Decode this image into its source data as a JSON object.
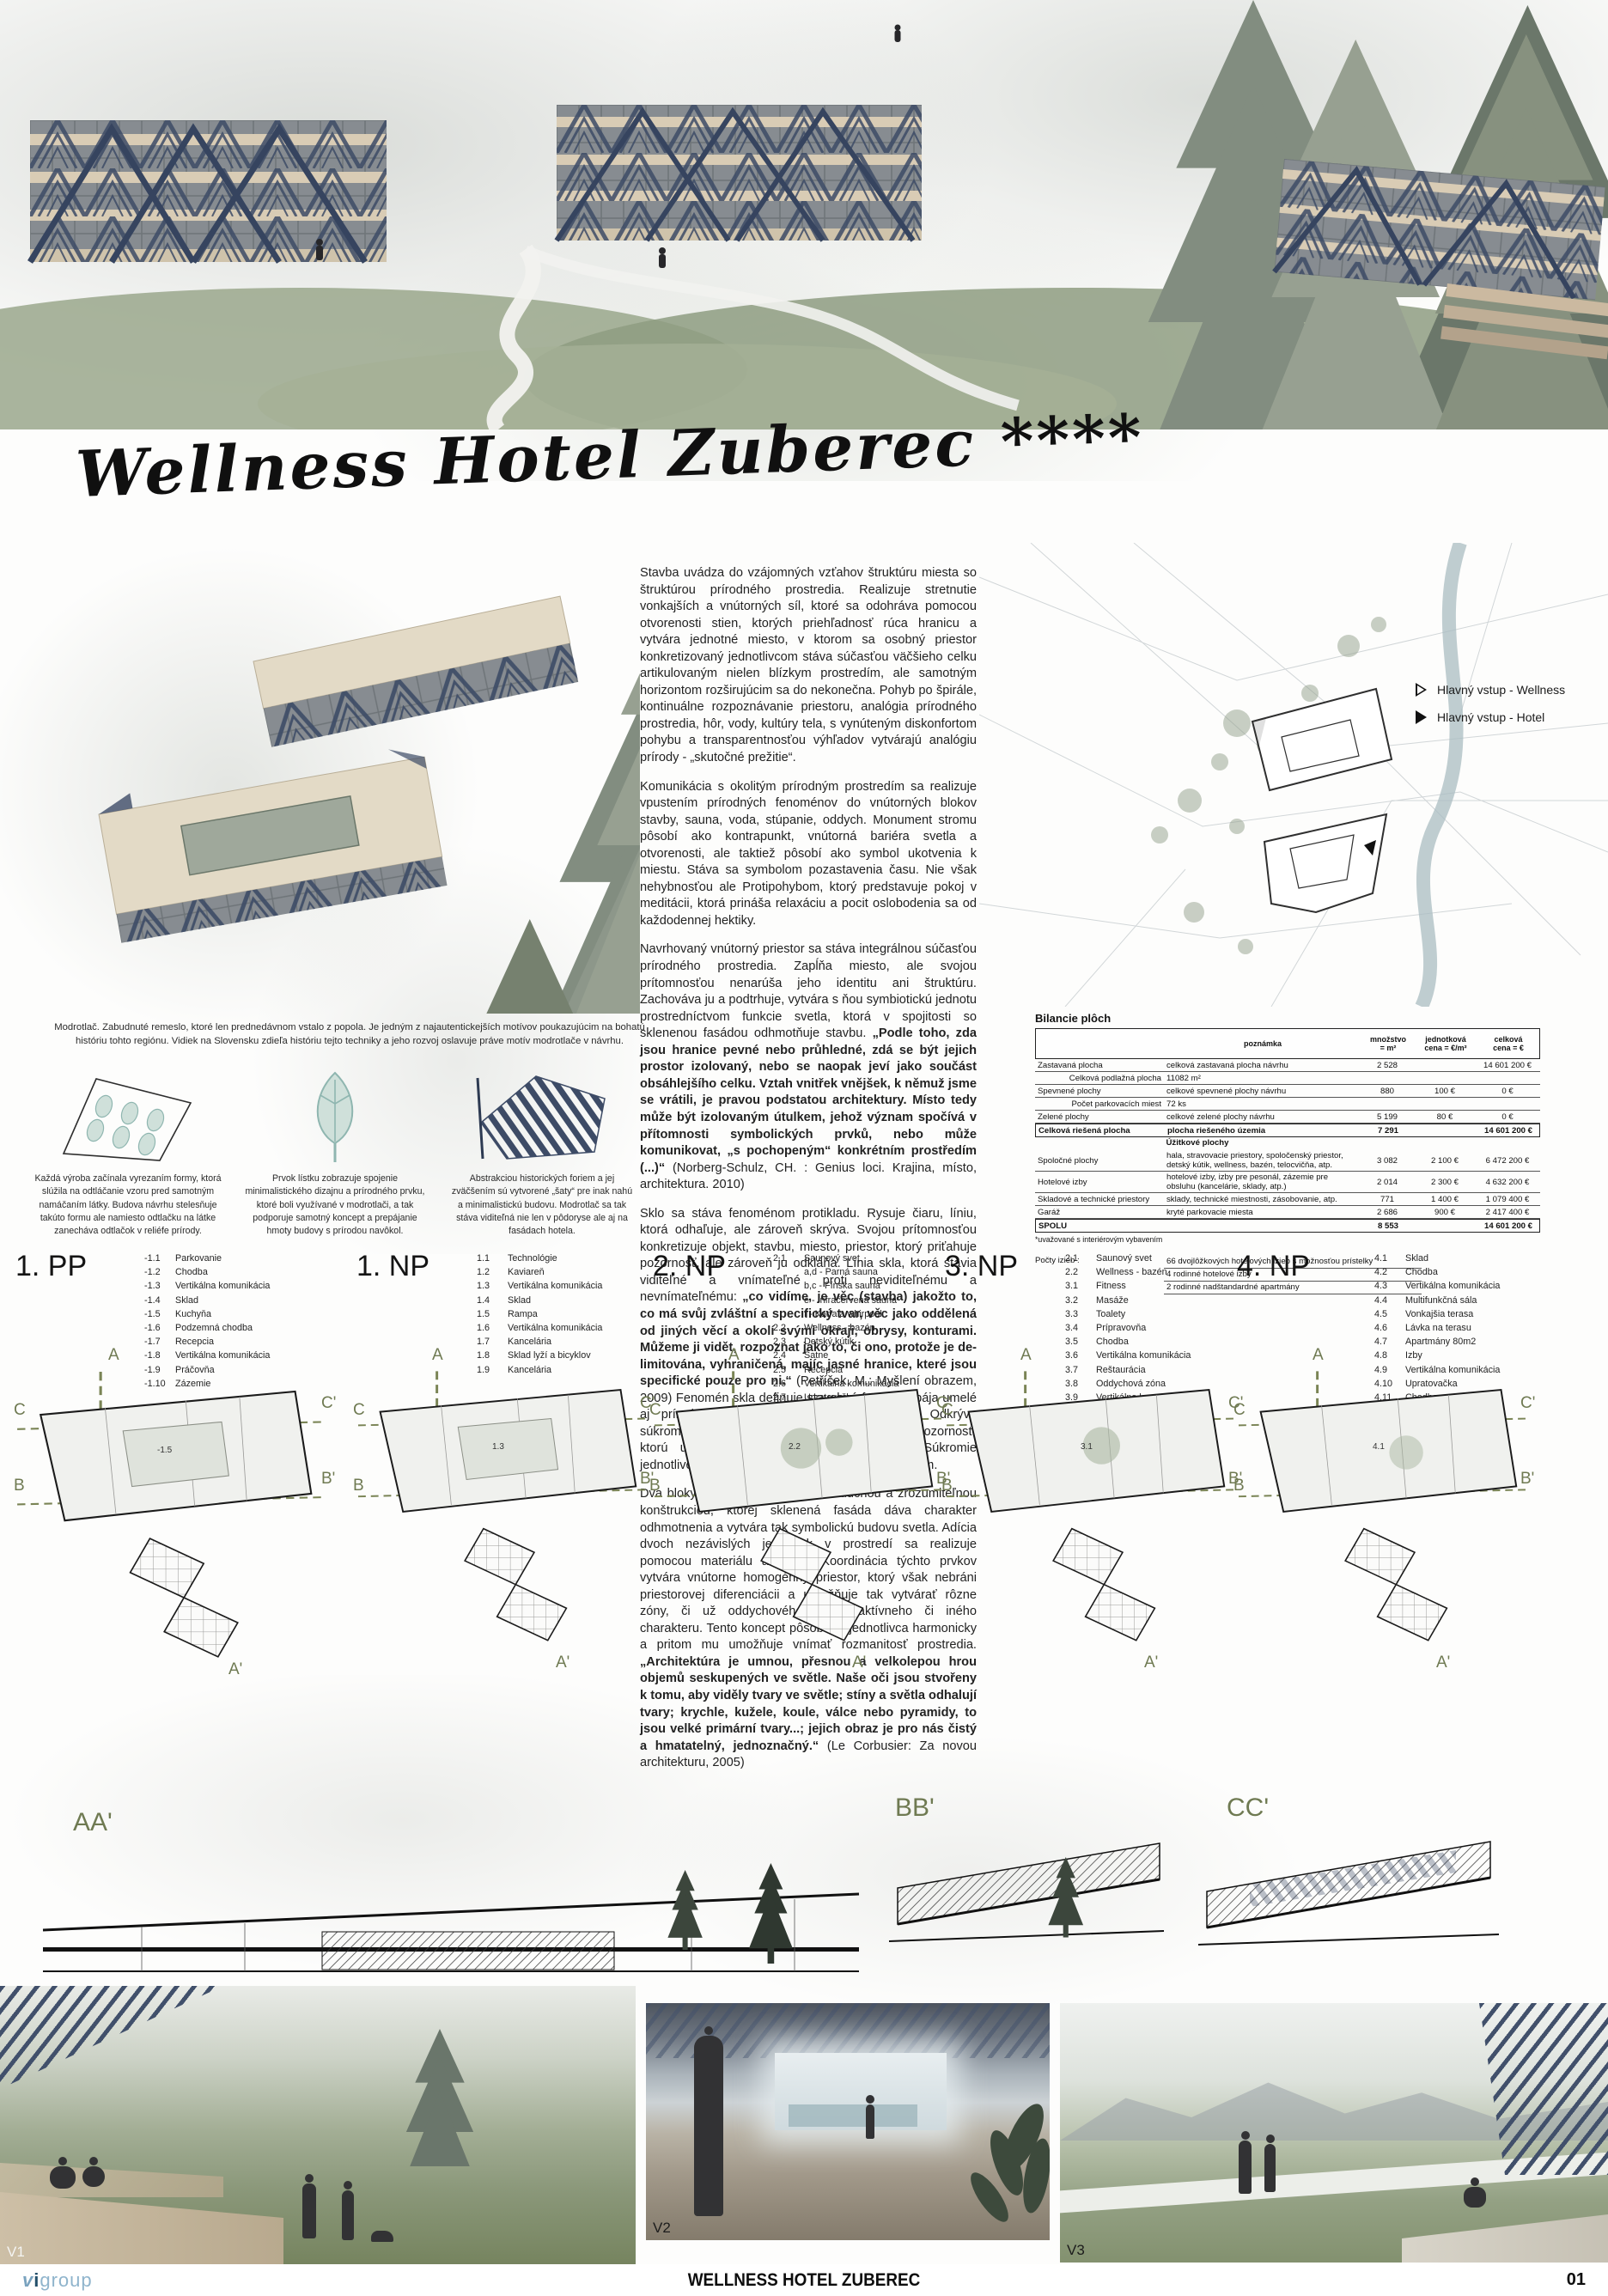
{
  "board": {
    "title_script": "Wellness Hotel Zuberec ****",
    "footer_title": "WELLNESS HOTEL ZUBEREC",
    "page_number": "01",
    "logo": {
      "mark_v": "v",
      "mark_i": "i",
      "word": "group"
    }
  },
  "colors": {
    "accent_navy": "#3d4b66",
    "olive": "#6f7a52",
    "sage_green": "#97a388",
    "beige_band": "#d9ccb5",
    "teal_leaf": "#9dbbb6",
    "logo_blue": "#24506b",
    "logo_light_blue": "#8fb4cc"
  },
  "site_legend": {
    "wellness": "Hlavný vstup - Wellness",
    "hotel": "Hlavný vstup - Hotel"
  },
  "essay": {
    "paragraphs": [
      [
        {
          "t": "Stavba uvádza do vzájomných vzťahov štruktúru miesta so štruktúrou prírodného prostredia. Realizuje stretnutie vonkajších a vnútorných síl, ktoré sa odohráva pomocou otvorenosti stien, ktorých priehľadnosť rúca hranicu a vytvára jednotné miesto, v ktorom sa osobný priestor konkretizovaný jednotlivcom stáva súčasťou väčšieho celku artikulovaným nielen blízkym prostredím, ale samotným horizontom rozširujúcim sa do nekonečna. Pohyb po špirále, kontinuálne rozpoznávanie priestoru, analógia prírodného prostredia, hôr, vody, kultúry tela, s vynúteným diskonfortom pohybu a transparentnosťou výhľadov vytvárajú analógiu prírody - „skutočné prežitie“."
        }
      ],
      [
        {
          "t": "Komunikácia s okolitým prírodným prostredím sa realizuje vpustením prírodných fenoménov do vnútorných blokov stavby, sauna, voda, stúpanie, oddych.  Monument stromu pôsobí ako kontrapunkt, vnútorná bariéra svetla a otvorenosti, ale taktiež pôsobí ako symbol ukotvenia k miestu. Stáva sa symbolom pozastavenia času. Nie však nehybnosťou ale Protipohybom, ktorý predstavuje pokoj v meditácii, ktorá prináša relaxáciu a pocit oslobodenia sa od každodennej hektiky."
        }
      ],
      [
        {
          "t": "Navrhovaný vnútorný priestor sa stáva integrálnou súčasťou prírodného prostredia. Zapĺňa miesto, ale svojou prítomnosťou nenarúša jeho identitu ani štruktúru. Zachováva ju a podtrhuje, vytvára s ňou symbiotickú jednotu prostredníctvom funkcie svetla, ktorá v spojitosti so sklenenou fasádou odhmotňuje stavbu. "
        },
        {
          "t": "„Podle toho, zda jsou hranice pevné nebo průhledné, zdá se být jejich prostor izolovaný, nebo se naopak jeví jako součást obsáhlejšího celku. Vztah vnitřek vnějšek, k němuž jsme se vrátili, je pravou podstatou architektury. Místo tedy může být izolovaným útulkem, jehož význam spočívá v přítomnosti symbolických prvků, nebo může komunikovat, „s pochopeným“ konkrétním prostředím (...)“",
          "b": true
        },
        {
          "t": " (Norberg-Schulz, CH. : Genius loci. Krajina, místo, architektura. 2010)"
        }
      ],
      [
        {
          "t": "Sklo sa stáva fenoménom protikladu. Rysuje čiaru, líniu, ktorá odhaľuje, ale zároveň skrýva. Svojou prítomnosťou konkretizuje objekt, stavbu, miesto, priestor, ktorý priťahuje pozornosť, ale zároveň ju odkláňa. Línia skla, ktorá stavia viditeľné a vnímateľné proti neviditeľnému a nevnímateľnému: "
        },
        {
          "t": "„co vidíme, je věc (stavba) jakožto to, co má svůj zvláštní a specifický tvar, věc jako oddělená od jiných věcí a okolí svými okraji, obrysy, konturami. Můžeme ji vidět, rozpoznat jako to, či ono, protože je de-limitována, vyhraničená, majíc jasné hranice, které jsou specifické pouze pro ni.“",
          "b": true
        },
        {
          "t": " (Petříček, M.: Myšlení obrazem, 2009) Fenomén skla definuje stavebnú formu a spája umelé aj prírodné prostredie do jednotného celku. Odkrýva súkromný priestor, ale zároveň od neho odkláňa pozornosť, ktorú upútavajú možnosti okolitej scenérie. Súkromie jednotlivca sa tak stáva anonymným a nepodstatným."
        }
      ],
      [
        {
          "t": "Dva bloky jednotnej stavby s jednoduchou a zrozumiteľnou konštrukciou, ktorej sklenená fasáda dáva charakter odhmotnenia a vytvára tak symbolickú budovu svetla. Adícia dvoch nezávislých jednotiek v prostredí sa realizuje pomocou materiálu a formy. Koordinácia týchto prvkov vytvára vnútorne homogénny priestor, ktorý však nebráni priestorovej diferenciácii a umožňuje tak vytvárať rôzne zóny, či už oddychového alebo aktívneho či iného charakteru. Tento koncept pôsobí na jednotlivca harmonicky a pritom mu umožňuje vnímať rozmanitosť prostredia. "
        },
        {
          "t": "„Architektúra je umnou, přesnou a velkolepou hrou objemů seskupených ve světle. Naše oči jsou stvořeny k tomu, aby viděly tvary ve světle; stíny a světla odhalují tvary; krychle, kužele, koule, válce nebo pyramidy, to jsou velké primární tvary...; jejich obraz je pro nás čistý a hmatatelný, jednoznačný.“",
          "b": true
        },
        {
          "t": " (Le Corbusier: Za novou architekturu, 2005)"
        }
      ]
    ]
  },
  "axon_caption": "Modrotlač. Zabudnuté remeslo, ktoré len prednedávnom vstalo z popola. Je jedným z najautentickejších motívov poukazujúcim na bohatú históriu tohto regiónu. Vidiek na Slovensku zdieľa históriu tejto techniky a jeho rozvoj oslavuje práve motív modrotlače v návrhu.",
  "concepts": [
    {
      "caption": "Každá výroba začínala vyrezaním formy, ktorá slúžila na odtláčanie vzoru pred samotným namáčaním látky. Budova návrhu stelesňuje takúto formu ale namiesto odtlačku na látke zanecháva odtlačok v reliéfe prírody."
    },
    {
      "caption": "Prvok lístku zobrazuje spojenie minimalistického dizajnu a prírodného prvku, ktoré boli využívané v modrotlači, a tak podporuje samotný koncept a prepájanie hmoty budovy s prírodou navôkol."
    },
    {
      "caption": "Abstrakciou historických foriem a jej zväčšením sú vytvorené „šaty“ pre inak nahú a minimalistickú budovu. Modrotlač sa tak stáva viditeľná nie len v pôdoryse ale aj na fasádach hotela."
    }
  ],
  "bilancia": {
    "title": "Bilancie plôch",
    "headers": {
      "note": "poznámka",
      "qty": "množstvo\n= m²",
      "unit": "jednotková\ncena = €/m²",
      "total": "celková\ncena = €"
    },
    "rows": [
      {
        "name": "Zastavaná plocha",
        "note": "celková zastavaná plocha návrhu",
        "qty": "2 528",
        "unit": "",
        "total": "14 601 200 €"
      },
      {
        "name": "Celková podlažná plocha",
        "note": "11082 m²",
        "qty": "",
        "unit": "",
        "total": "",
        "sub": true
      },
      {
        "name": "Spevnené plochy",
        "note": "celkové spevnené plochy návrhu",
        "qty": "880",
        "unit": "100 €",
        "total": "0 €"
      },
      {
        "name": "Počet parkovacích miest",
        "note": "72 ks",
        "qty": "",
        "unit": "",
        "total": "",
        "sub": true
      },
      {
        "name": "Zelené plochy",
        "note": "celkové zelené plochy návrhu",
        "qty": "5 199",
        "unit": "80 €",
        "total": "0 €"
      },
      {
        "name": "Celková riešená plocha",
        "note": "plocha riešeného územia",
        "qty": "7 291",
        "unit": "",
        "total": "14 601 200 €",
        "bold": true
      },
      {
        "name": "Úžitkové plochy",
        "note": "",
        "qty": "",
        "unit": "",
        "total": "",
        "section": true
      },
      {
        "name": "Spoločné plochy",
        "note": "hala, stravovacie priestory, spoločenský priestor, detský kútik, wellness, bazén, telocvičňa, atp.",
        "qty": "3 082",
        "unit": "2 100 €",
        "total": "6 472 200 €"
      },
      {
        "name": "Hotelové izby",
        "note": "hotelové izby, izby pre pesonál, zázemie pre obsluhu (kancelárie, sklady, atp.)",
        "qty": "2 014",
        "unit": "2 300 €",
        "total": "4 632 200 €"
      },
      {
        "name": "Skladové a technické priestory",
        "note": "sklady, technické miestnosti, zásobovanie, atp.",
        "qty": "771",
        "unit": "1 400 €",
        "total": "1 079 400 €"
      },
      {
        "name": "Garáž",
        "note": "kryté parkovacie miesta",
        "qty": "2 686",
        "unit": "900 €",
        "total": "2 417 400 €"
      },
      {
        "name": "SPOLU",
        "note": "",
        "qty": "8 553",
        "unit": "",
        "total": "14 601 200 €",
        "bold": true
      }
    ],
    "footnote": "*uvažované s interiérovým vybavením",
    "rooms_label": "Počty izieb :",
    "room_counts": [
      "66 dvojlôžkových hotelových izieb s možnosťou prístelky",
      "4 rodinné hotelové izby",
      "2 rodinné nadštandardné apartmány"
    ]
  },
  "markers": {
    "a": "A",
    "a2": "A'",
    "b": "B",
    "b2": "B'",
    "c": "C",
    "c2": "C'"
  },
  "plans": [
    {
      "title": "1. PP",
      "room_label": "-1.5",
      "items": [
        {
          "num": "-1.1",
          "label": "Parkovanie"
        },
        {
          "num": "-1.2",
          "label": "Chodba"
        },
        {
          "num": "-1.3",
          "label": "Vertikálna komunikácia"
        },
        {
          "num": "-1.4",
          "label": "Sklad"
        },
        {
          "num": "-1.5",
          "label": "Kuchyňa"
        },
        {
          "num": "-1.6",
          "label": "Podzemná chodba"
        },
        {
          "num": "-1.7",
          "label": "Recepcia"
        },
        {
          "num": "-1.8",
          "label": "Vertikálna komunikácia"
        },
        {
          "num": "-1.9",
          "label": "Práčovňa"
        },
        {
          "num": "-1.10",
          "label": "Zázemie"
        }
      ]
    },
    {
      "title": "1. NP",
      "room_label": "1.3",
      "items": [
        {
          "num": "1.1",
          "label": "Technológie"
        },
        {
          "num": "1.2",
          "label": "Kaviareň"
        },
        {
          "num": "1.3",
          "label": "Vertikálna komunikácia"
        },
        {
          "num": "1.4",
          "label": "Sklad"
        },
        {
          "num": "1.5",
          "label": "Rampa"
        },
        {
          "num": "1.6",
          "label": "Vertikálna komunikácia"
        },
        {
          "num": "1.7",
          "label": "Kancelária"
        },
        {
          "num": "1.8",
          "label": "Sklad lyží a bicyklov"
        },
        {
          "num": "1.9",
          "label": "Kancelária"
        }
      ]
    },
    {
      "title": "2. NP",
      "room_label": "2.2",
      "items": [
        {
          "num": "2.1",
          "label": "Saunový svet"
        },
        {
          "num": "",
          "label": "a,d - Parná sauna"
        },
        {
          "num": "",
          "label": "b,c - Fínska sauna"
        },
        {
          "num": "",
          "label": "e - Infračervená sauna"
        },
        {
          "num": "",
          "label": "f - Kaďa a whirpool"
        },
        {
          "num": "2.2",
          "label": "Wellness - bazén"
        },
        {
          "num": "2.3",
          "label": "Detský kútik"
        },
        {
          "num": "2.4",
          "label": "Šatne"
        },
        {
          "num": "2.5",
          "label": "Recepcia"
        },
        {
          "num": "2.6",
          "label": "Vertikálna komunikácia"
        },
        {
          "num": "2.7",
          "label": "Upratovačka"
        },
        {
          "num": "2.8",
          "label": "Vertikálna komunikácia"
        },
        {
          "num": "2.9",
          "label": "Izby"
        },
        {
          "num": "2.10",
          "label": "Chodba"
        }
      ]
    },
    {
      "title": "3. NP",
      "room_label": "3.1",
      "items": [
        {
          "num": "2.1",
          "label": "Saunový svet"
        },
        {
          "num": "2.2",
          "label": "Wellness - bazén"
        },
        {
          "num": "3.1",
          "label": "Fitness"
        },
        {
          "num": "3.2",
          "label": "Masáže"
        },
        {
          "num": "3.3",
          "label": "Toalety"
        },
        {
          "num": "3.4",
          "label": "Prípravovňa"
        },
        {
          "num": "3.5",
          "label": "Chodba"
        },
        {
          "num": "3.6",
          "label": "Vertikálna komunikácia"
        },
        {
          "num": "3.7",
          "label": "Reštaurácia"
        },
        {
          "num": "3.8",
          "label": "Oddychová zóna"
        },
        {
          "num": "3.9",
          "label": "Vertikálna komunikácia"
        },
        {
          "num": "3.10",
          "label": "Upratovačka"
        },
        {
          "num": "3.11",
          "label": "Izby"
        },
        {
          "num": "3.12",
          "label": "Chodba"
        }
      ]
    },
    {
      "title": "4. NP",
      "room_label": "4.1",
      "items": [
        {
          "num": "4.1",
          "label": "Sklad"
        },
        {
          "num": "4.2",
          "label": "Chodba"
        },
        {
          "num": "4.3",
          "label": "Vertikálna komunikácia"
        },
        {
          "num": "4.4",
          "label": "Multifunkčná sála"
        },
        {
          "num": "4.5",
          "label": "Vonkajšia terasa"
        },
        {
          "num": "4.6",
          "label": "Lávka na terasu"
        },
        {
          "num": "4.7",
          "label": "Apartmány 80m2"
        },
        {
          "num": "4.8",
          "label": "Izby"
        },
        {
          "num": "4.9",
          "label": "Vertikálna komunikácia"
        },
        {
          "num": "4.10",
          "label": "Upratovačka"
        },
        {
          "num": "4.11",
          "label": "Chodba"
        }
      ]
    }
  ],
  "sections": [
    "AA'",
    "BB'",
    "CC'"
  ],
  "views": [
    "V1",
    "V2",
    "V3"
  ]
}
